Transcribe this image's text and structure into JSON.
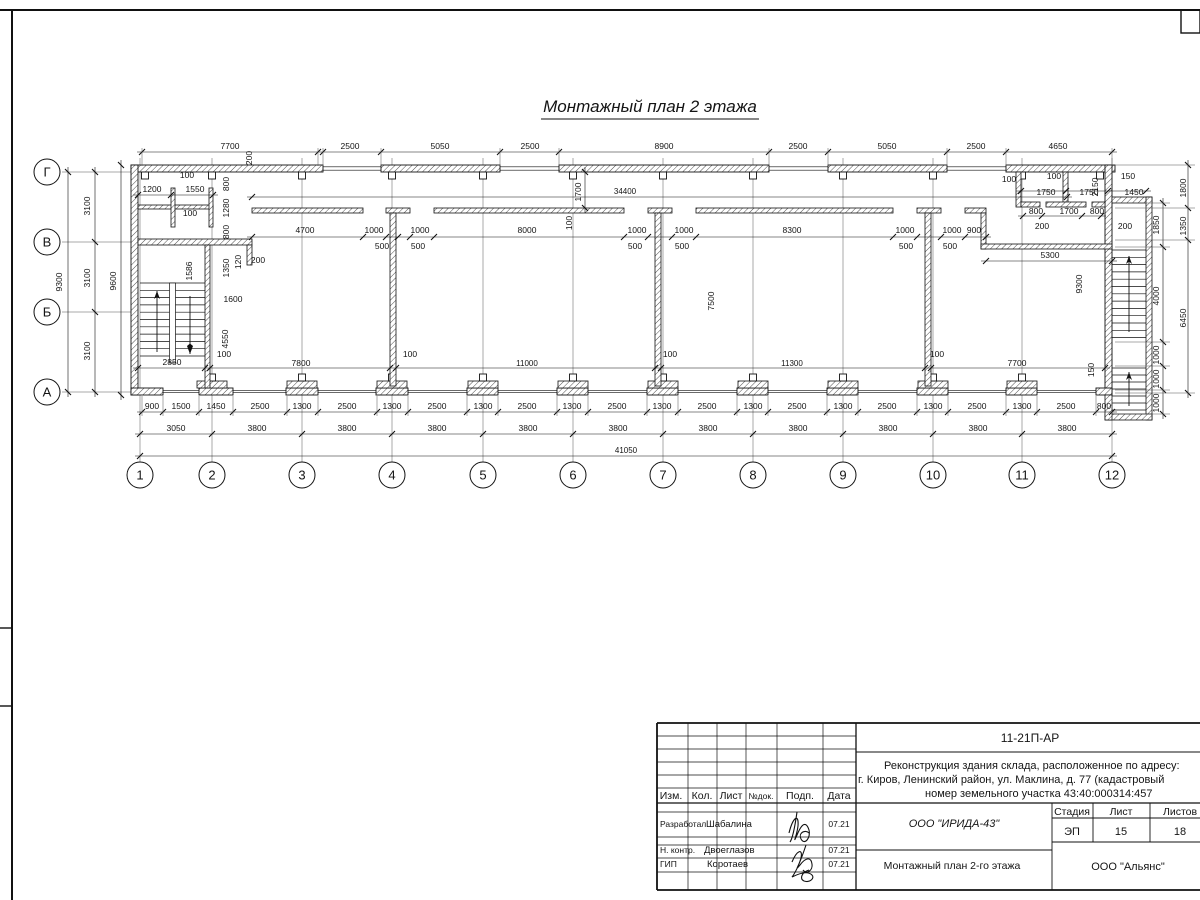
{
  "title": "Монтажный план 2 этажа",
  "axes": {
    "cols": [
      {
        "label": "1",
        "x": 140
      },
      {
        "label": "2",
        "x": 212
      },
      {
        "label": "3",
        "x": 302
      },
      {
        "label": "4",
        "x": 392
      },
      {
        "label": "5",
        "x": 483
      },
      {
        "label": "6",
        "x": 573
      },
      {
        "label": "7",
        "x": 663
      },
      {
        "label": "8",
        "x": 753
      },
      {
        "label": "9",
        "x": 843
      },
      {
        "label": "10",
        "x": 933
      },
      {
        "label": "11",
        "x": 1022
      },
      {
        "label": "12",
        "x": 1112
      }
    ],
    "rows": [
      {
        "label": "Г",
        "y": 172
      },
      {
        "label": "В",
        "y": 242
      },
      {
        "label": "Б",
        "y": 312
      },
      {
        "label": "А",
        "y": 392
      }
    ]
  },
  "dim_labels": [
    [
      "7700",
      230,
      149,
      0
    ],
    [
      "200",
      252,
      158,
      1
    ],
    [
      "2500",
      350,
      149,
      0
    ],
    [
      "5050",
      440,
      149,
      0
    ],
    [
      "2500",
      530,
      149,
      0
    ],
    [
      "8900",
      664,
      149,
      0
    ],
    [
      "2500",
      798,
      149,
      0
    ],
    [
      "5050",
      887,
      149,
      0
    ],
    [
      "2500",
      976,
      149,
      0
    ],
    [
      "4650",
      1058,
      149,
      0
    ],
    [
      "34400",
      625,
      194,
      0
    ],
    [
      "1700",
      581,
      192,
      1
    ],
    [
      "100",
      572,
      223,
      1
    ],
    [
      "100",
      187,
      178,
      0
    ],
    [
      "1200",
      152,
      192,
      0
    ],
    [
      "1550",
      195,
      192,
      0
    ],
    [
      "100",
      190,
      216,
      0
    ],
    [
      "800",
      229,
      184,
      1
    ],
    [
      "1280",
      229,
      208,
      1
    ],
    [
      "800",
      229,
      232,
      1
    ],
    [
      "1350",
      229,
      268,
      1
    ],
    [
      "120",
      241,
      262,
      1
    ],
    [
      "200",
      258,
      263,
      0
    ],
    [
      "1586",
      192,
      271,
      1
    ],
    [
      "1600",
      233,
      302,
      0
    ],
    [
      "4550",
      228,
      339,
      1
    ],
    [
      "100",
      224,
      357,
      0
    ],
    [
      "2850",
      172,
      365,
      0
    ],
    [
      "3100",
      90,
      206,
      1
    ],
    [
      "3100",
      90,
      278,
      1
    ],
    [
      "3100",
      90,
      351,
      1
    ],
    [
      "9300",
      62,
      282,
      1
    ],
    [
      "9600",
      116,
      281,
      1
    ],
    [
      "4700",
      305,
      233,
      0
    ],
    [
      "1000",
      374,
      233,
      0
    ],
    [
      "500",
      382,
      249,
      0
    ],
    [
      "1000",
      420,
      233,
      0
    ],
    [
      "500",
      418,
      249,
      0
    ],
    [
      "8000",
      527,
      233,
      0
    ],
    [
      "1000",
      637,
      233,
      0
    ],
    [
      "500",
      635,
      249,
      0
    ],
    [
      "1000",
      684,
      233,
      0
    ],
    [
      "500",
      682,
      249,
      0
    ],
    [
      "8300",
      792,
      233,
      0
    ],
    [
      "1000",
      905,
      233,
      0
    ],
    [
      "500",
      906,
      249,
      0
    ],
    [
      "1000",
      952,
      233,
      0
    ],
    [
      "500",
      950,
      249,
      0
    ],
    [
      "900",
      974,
      233,
      0
    ],
    [
      "5300",
      1050,
      258,
      0
    ],
    [
      "9300",
      1082,
      284,
      1
    ],
    [
      "7500",
      714,
      301,
      1
    ],
    [
      "100",
      1009,
      182,
      0
    ],
    [
      "100",
      1054,
      179,
      0
    ],
    [
      "150",
      1128,
      179,
      0
    ],
    [
      "1750",
      1046,
      195,
      0
    ],
    [
      "1750",
      1089,
      195,
      0
    ],
    [
      "2150",
      1098,
      187,
      1
    ],
    [
      "1450",
      1134,
      195,
      0
    ],
    [
      "800",
      1036,
      214,
      0
    ],
    [
      "1700",
      1069,
      214,
      0
    ],
    [
      "800",
      1097,
      214,
      0
    ],
    [
      "200",
      1042,
      229,
      0
    ],
    [
      "200",
      1125,
      229,
      0
    ],
    [
      "100",
      410,
      357,
      0
    ],
    [
      "100",
      670,
      357,
      0
    ],
    [
      "100",
      937,
      357,
      0
    ],
    [
      "7800",
      301,
      366,
      0
    ],
    [
      "11000",
      527,
      366,
      0
    ],
    [
      "11300",
      792,
      366,
      0
    ],
    [
      "7700",
      1017,
      366,
      0
    ],
    [
      "150",
      1094,
      370,
      1
    ],
    [
      "1850",
      1159,
      225,
      1
    ],
    [
      "4000",
      1159,
      296,
      1
    ],
    [
      "1000",
      1159,
      355,
      1
    ],
    [
      "1000",
      1159,
      379,
      1
    ],
    [
      "1000",
      1159,
      403,
      1
    ],
    [
      "1800",
      1186,
      188,
      1
    ],
    [
      "1350",
      1186,
      226,
      1
    ],
    [
      "6450",
      1186,
      318,
      1
    ],
    [
      "900",
      152,
      409,
      0
    ],
    [
      "1500",
      181,
      409,
      0
    ],
    [
      "1450",
      216,
      409,
      0
    ],
    [
      "2500",
      260,
      409,
      0
    ],
    [
      "1300",
      302,
      409,
      0
    ],
    [
      "2500",
      347,
      409,
      0
    ],
    [
      "1300",
      392,
      409,
      0
    ],
    [
      "2500",
      437,
      409,
      0
    ],
    [
      "1300",
      483,
      409,
      0
    ],
    [
      "2500",
      527,
      409,
      0
    ],
    [
      "1300",
      572,
      409,
      0
    ],
    [
      "2500",
      617,
      409,
      0
    ],
    [
      "1300",
      662,
      409,
      0
    ],
    [
      "2500",
      707,
      409,
      0
    ],
    [
      "1300",
      753,
      409,
      0
    ],
    [
      "2500",
      797,
      409,
      0
    ],
    [
      "1300",
      843,
      409,
      0
    ],
    [
      "2500",
      887,
      409,
      0
    ],
    [
      "1300",
      933,
      409,
      0
    ],
    [
      "2500",
      977,
      409,
      0
    ],
    [
      "1300",
      1022,
      409,
      0
    ],
    [
      "2500",
      1066,
      409,
      0
    ],
    [
      "800",
      1104,
      409,
      0
    ],
    [
      "3050",
      176,
      431,
      0
    ],
    [
      "3800",
      257,
      431,
      0
    ],
    [
      "3800",
      347,
      431,
      0
    ],
    [
      "3800",
      437,
      431,
      0
    ],
    [
      "3800",
      528,
      431,
      0
    ],
    [
      "3800",
      618,
      431,
      0
    ],
    [
      "3800",
      708,
      431,
      0
    ],
    [
      "3800",
      798,
      431,
      0
    ],
    [
      "3800",
      888,
      431,
      0
    ],
    [
      "3800",
      978,
      431,
      0
    ],
    [
      "3800",
      1067,
      431,
      0
    ],
    [
      "41050",
      626,
      453,
      0
    ]
  ],
  "title_block": {
    "doc_number": "11-21П-АР",
    "project": [
      "Реконструкция здания склада, расположенное по адресу:",
      "г. Киров, Ленинский район, ул. Маклина, д. 77 (кадастровый",
      "номер земельного участка 43:40:000314:457"
    ],
    "columns": [
      "Изм.",
      "Кол.",
      "Лист",
      "№док.",
      "Подп.",
      "Дата"
    ],
    "signers": [
      {
        "role": "Разработал",
        "name": "Шабалина",
        "date": "07.21"
      },
      {
        "role": "Н. контр.",
        "name": "Двоеглазов",
        "date": "07.21"
      },
      {
        "role": "ГИП",
        "name": "Коротаев",
        "date": "07.21"
      }
    ],
    "design_org": "ООО \"ИРИДА-43\"",
    "sheet_title": "Монтажный план 2-го этажа",
    "customer_org": "ООО \"Альянс\"",
    "stage_cols": [
      "Стадия",
      "Лист",
      "Листов"
    ],
    "stage": "ЭП",
    "sheet_no": "15",
    "sheets_total": "18"
  }
}
